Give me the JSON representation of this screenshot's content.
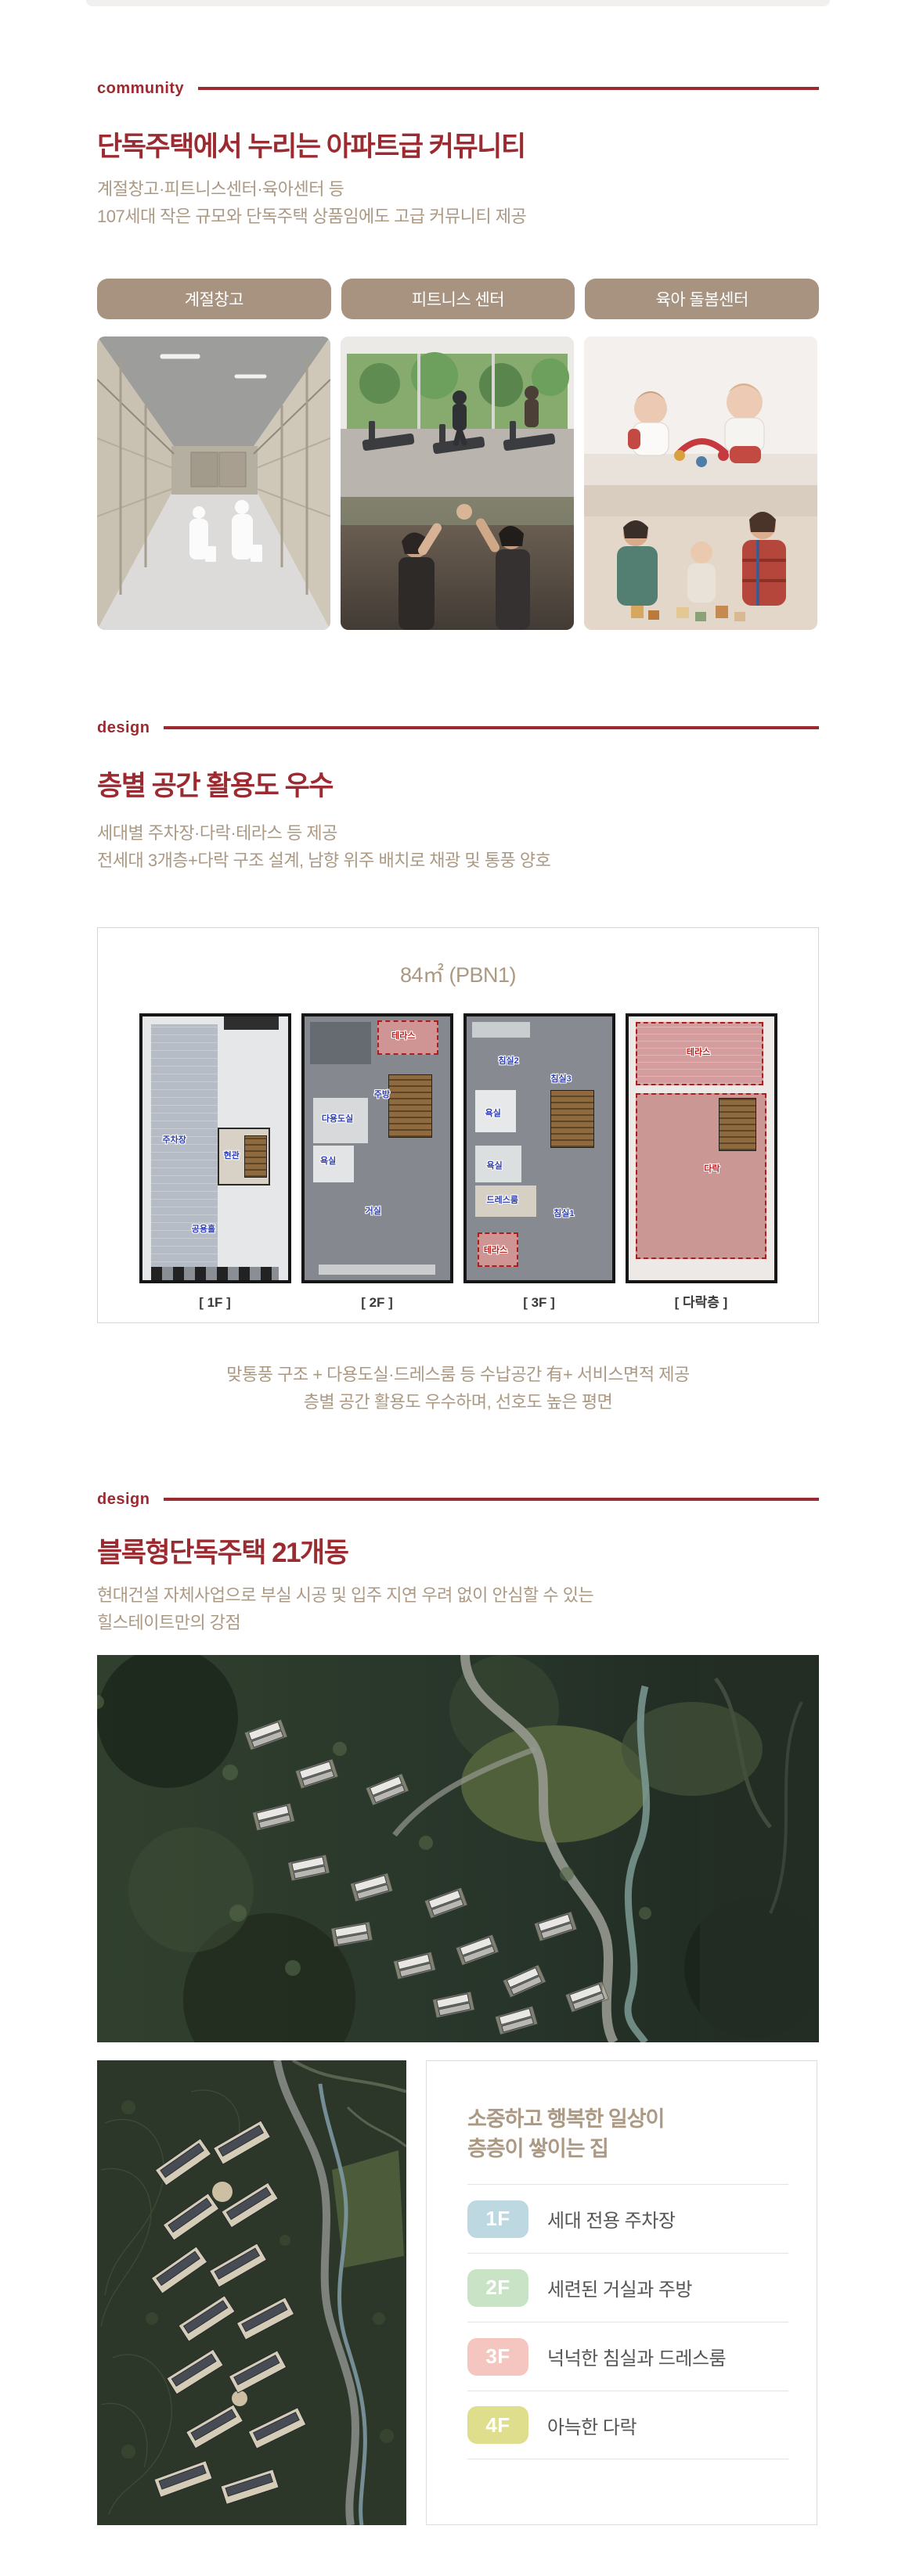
{
  "brand": {
    "accent_red": "#9c2b31",
    "tan_text": "#ab9983",
    "tan_button": "#a79380"
  },
  "sections": {
    "community": {
      "label": "community",
      "title": "단독주택에서 누리는 아파트급 커뮤니티",
      "subtitle_lines": [
        "계절창고·피트니스센터·육아센터 등",
        "107세대 작은 규모와 단독주택 상품임에도 고급 커뮤니티 제공"
      ],
      "tabs": [
        {
          "label": "계절창고"
        },
        {
          "label": "피트니스 센터"
        },
        {
          "label": "육아 돌봄센터"
        }
      ]
    },
    "design1": {
      "label": "design",
      "title": "층별 공간 활용도 우수",
      "subtitle_lines": [
        "세대별 주차장·다락·테라스 등 제공",
        "전세대 3개층+다락 구조 설계, 남향 위주 배치로 채광 및 통풍 양호"
      ],
      "floorplan": {
        "title": "84㎡ (PBN1)",
        "floors": [
          {
            "caption": "[ 1F ]",
            "rooms": [
              "주차장",
              "현관",
              "공용홀"
            ]
          },
          {
            "caption": "[ 2F ]",
            "rooms": [
              "테라스",
              "주방",
              "다용도실",
              "욕실",
              "거실"
            ]
          },
          {
            "caption": "[ 3F ]",
            "rooms": [
              "침실2",
              "침실3",
              "욕실",
              "욕실",
              "드레스룸",
              "침실1",
              "테라스"
            ]
          },
          {
            "caption": "[ 다락층 ]",
            "rooms": [
              "테라스",
              "다락"
            ]
          }
        ]
      },
      "footnote_lines": [
        "맞통풍 구조 + 다용도실·드레스룸 등 수납공간 有+ 서비스면적 제공",
        "층별 공간 활용도 우수하며, 선호도 높은 평면"
      ]
    },
    "design2": {
      "label": "design",
      "title": "블록형단독주택 21개동",
      "subtitle_lines": [
        "현대건설 자체사업으로 부실 시공 및 입주 지연 우려 없이 안심할 수 있는",
        "힐스테이트만의 강점"
      ],
      "panel": {
        "heading_lines": [
          "소중하고 행복한 일상이",
          "층층이 쌓이는 집"
        ],
        "items": [
          {
            "badge": "1F",
            "color": "#bdd8e1",
            "label": "세대 전용 주차장"
          },
          {
            "badge": "2F",
            "color": "#c9e3c6",
            "label": "세련된 거실과 주방"
          },
          {
            "badge": "3F",
            "color": "#f5c5bf",
            "label": "넉넉한 침실과 드레스룸"
          },
          {
            "badge": "4F",
            "color": "#dede8d",
            "label": "아늑한 다락"
          }
        ]
      }
    }
  }
}
